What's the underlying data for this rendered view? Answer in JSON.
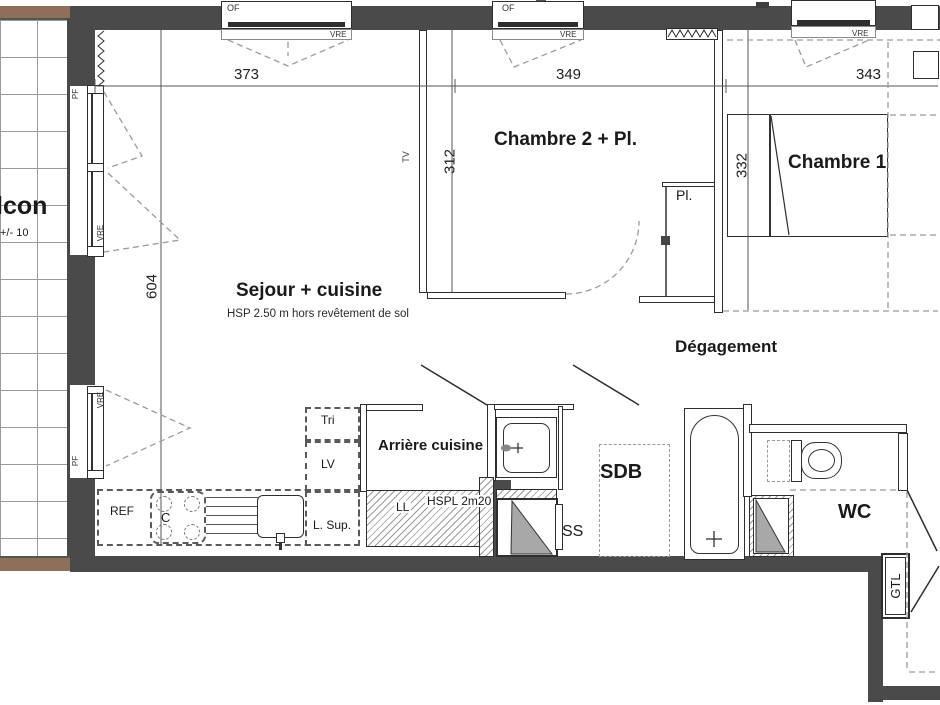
{
  "plan": {
    "balcony_label": "lcon",
    "balcony_level": "+/- 10",
    "rooms": {
      "sejour": "Sejour + cuisine",
      "sejour_note": "HSP 2.50 m hors revêtement de sol",
      "chambre2": "Chambre 2 + Pl.",
      "chambre1": "Chambre 1",
      "degagement": "Dégagement",
      "arriere_cuisine": "Arrière cuisine",
      "sdb": "SDB",
      "wc": "WC",
      "placard": "Pl."
    },
    "dimensions": {
      "sejour_width": "373",
      "chambre2_width": "349",
      "chambre1_width": "343",
      "sejour_depth": "604",
      "chambre2_depth": "312",
      "chambre1_depth": "332"
    },
    "openings": {
      "of": "OF",
      "vre": "VRE",
      "pf": "PF"
    },
    "equipment": {
      "tv": "TV",
      "ref": "REF",
      "cooktop": "C",
      "dishwasher": "LV",
      "tri": "Tri",
      "l_sup": "L. Sup.",
      "washer": "LL",
      "hspl": "HSPL 2m20",
      "shaft": "SS",
      "gtl": "GTL"
    },
    "colors": {
      "wall": "#4a4a4a",
      "balcony_edge": "#8d6f5b",
      "shaft_triangle": "#a8a8a8"
    }
  }
}
